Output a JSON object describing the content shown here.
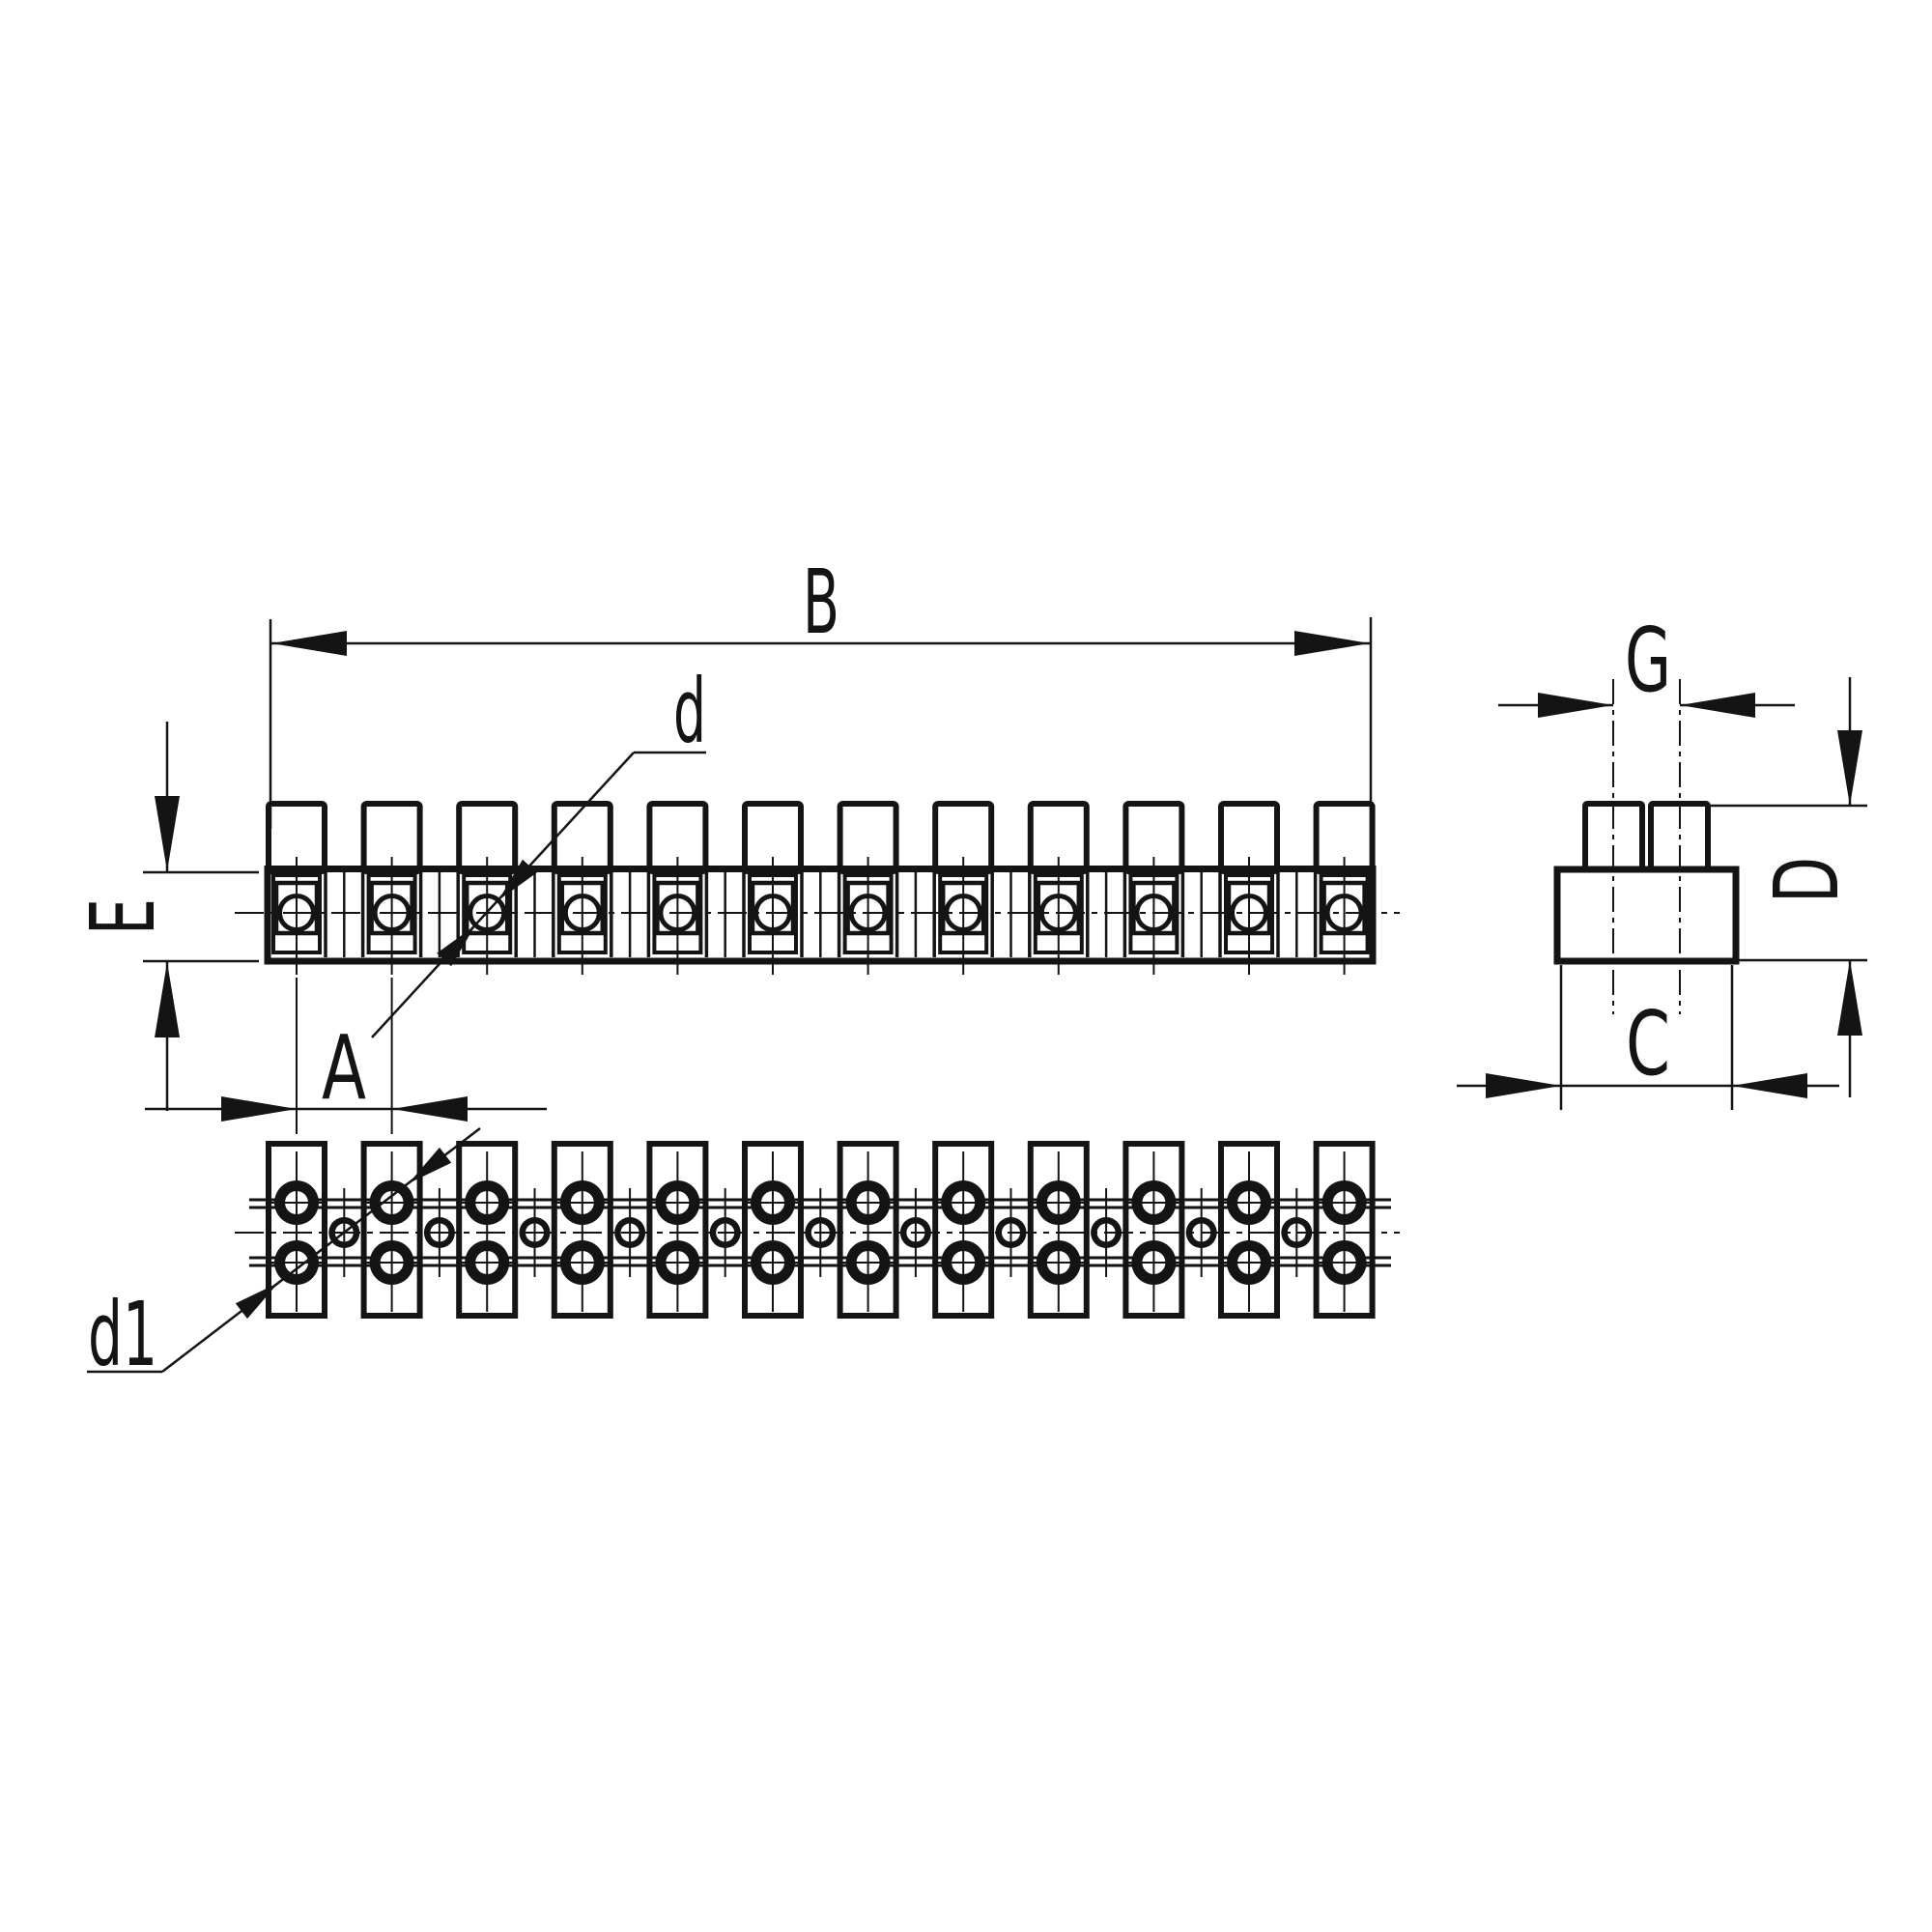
{
  "drawing": {
    "title": "terminal-strip-dimension-drawing",
    "background_color": "#ffffff",
    "ink_color": "#141414",
    "labels": {
      "B": "B",
      "d": "d",
      "E": "E",
      "A": "A",
      "d1": "d1",
      "G": "G",
      "D": "D",
      "C": "C"
    },
    "views": {
      "front": {
        "terminal_count": 12
      },
      "bottom": {
        "terminal_count": 12,
        "hole_rows": 2,
        "intermediate_hole_count": 11
      },
      "side": {
        "tab_count": 2
      }
    }
  }
}
